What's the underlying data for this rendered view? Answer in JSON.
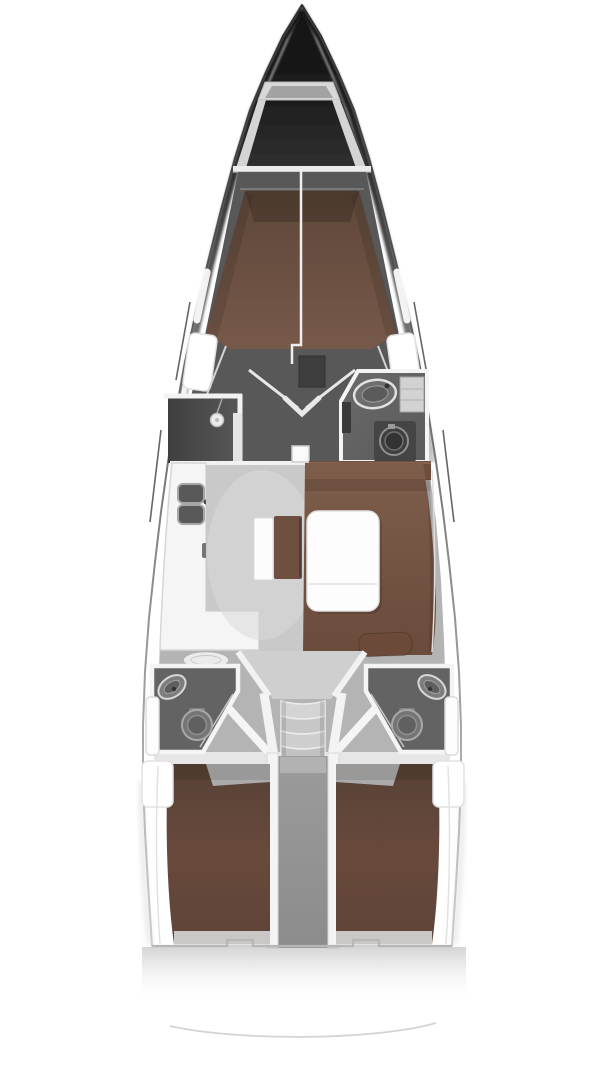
{
  "diagram": {
    "type": "yacht-interior-floor-plan",
    "view": "top-down",
    "orientation": "bow-up",
    "background": "#ffffff",
    "palette": {
      "hull_dark": "#161616",
      "hull_edge": "#555555",
      "deck_white": "#ffffff",
      "wall_white": "#f4f4f4",
      "salon_floor": "#c9c9c9",
      "cabin_floor_dark": "#585858",
      "wet_room_gray": "#5f5f5f",
      "bed_brown": "#6b4d3f",
      "settee_brown": "#7a5a48",
      "wood_trim": "#6d4e3c",
      "furniture_white": "#fdfdfd",
      "fixture_gray": "#757575",
      "anchor_locker_gray": "#d8d8d8",
      "transom_line": "#b6b6b6"
    },
    "areas": [
      {
        "id": "hull",
        "label": "Hull outline with side decks and hull windows"
      },
      {
        "id": "bow-anchor-locker",
        "label": "Bow anchor locker and foredeck"
      },
      {
        "id": "forward-cabin",
        "label": "Forward cabin with V-berth double bed"
      },
      {
        "id": "forward-shower",
        "label": "Forward shower stall, port side"
      },
      {
        "id": "forward-head",
        "label": "Forward head with washbasin, cabinet and washer, starboard side"
      },
      {
        "id": "galley",
        "label": "L-shaped galley with twin sinks and stove, port side"
      },
      {
        "id": "salon",
        "label": "Salon with U-shaped settee, folding table and center bench seats"
      },
      {
        "id": "companionway",
        "label": "Companionway steps and engine compartment"
      },
      {
        "id": "aft-head-port",
        "label": "Aft head with basin and toilet, port side"
      },
      {
        "id": "aft-head-starboard",
        "label": "Aft head with basin and toilet, starboard side"
      },
      {
        "id": "aft-cabin-port",
        "label": "Aft double cabin, port side"
      },
      {
        "id": "aft-cabin-starboard",
        "label": "Aft double cabin, starboard side"
      },
      {
        "id": "transom",
        "label": "Stern transom with swim platform edge"
      }
    ]
  }
}
